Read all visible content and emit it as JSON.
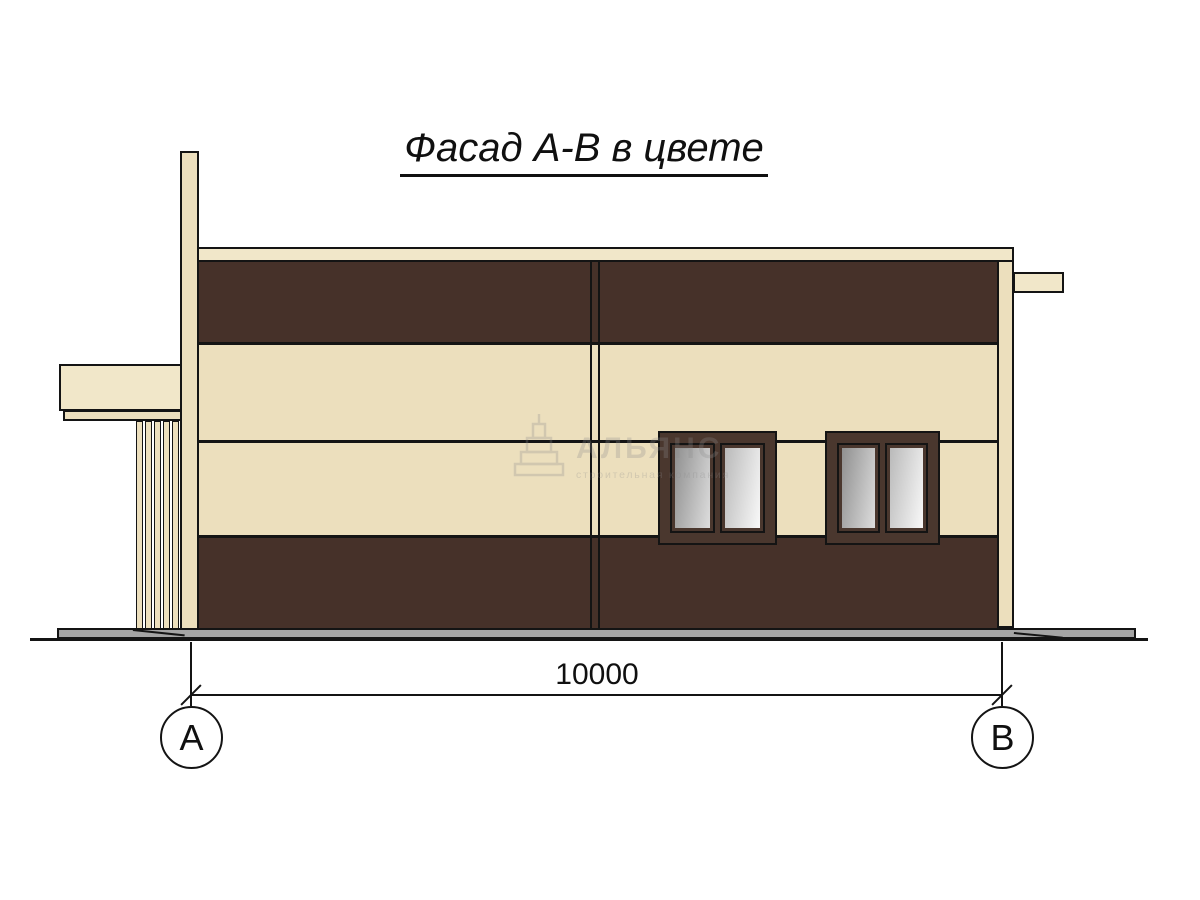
{
  "drawing": {
    "title": "Фасад А-В в цвете",
    "dimension_value": "10000",
    "axis_markers": {
      "left": "А",
      "right": "В"
    }
  },
  "watermark": {
    "name": "АЛЬЯНС",
    "subtitle": "строительная компания"
  },
  "colors": {
    "cream": "#ecdfbd",
    "cream_light": "#f1e7c9",
    "brown": "#463129",
    "frame_brown": "#4a372e",
    "base_gray": "#a4a4a4",
    "line": "#141414",
    "glass_dark": "#8a8a8a",
    "glass_light": "#fdfdfd"
  }
}
